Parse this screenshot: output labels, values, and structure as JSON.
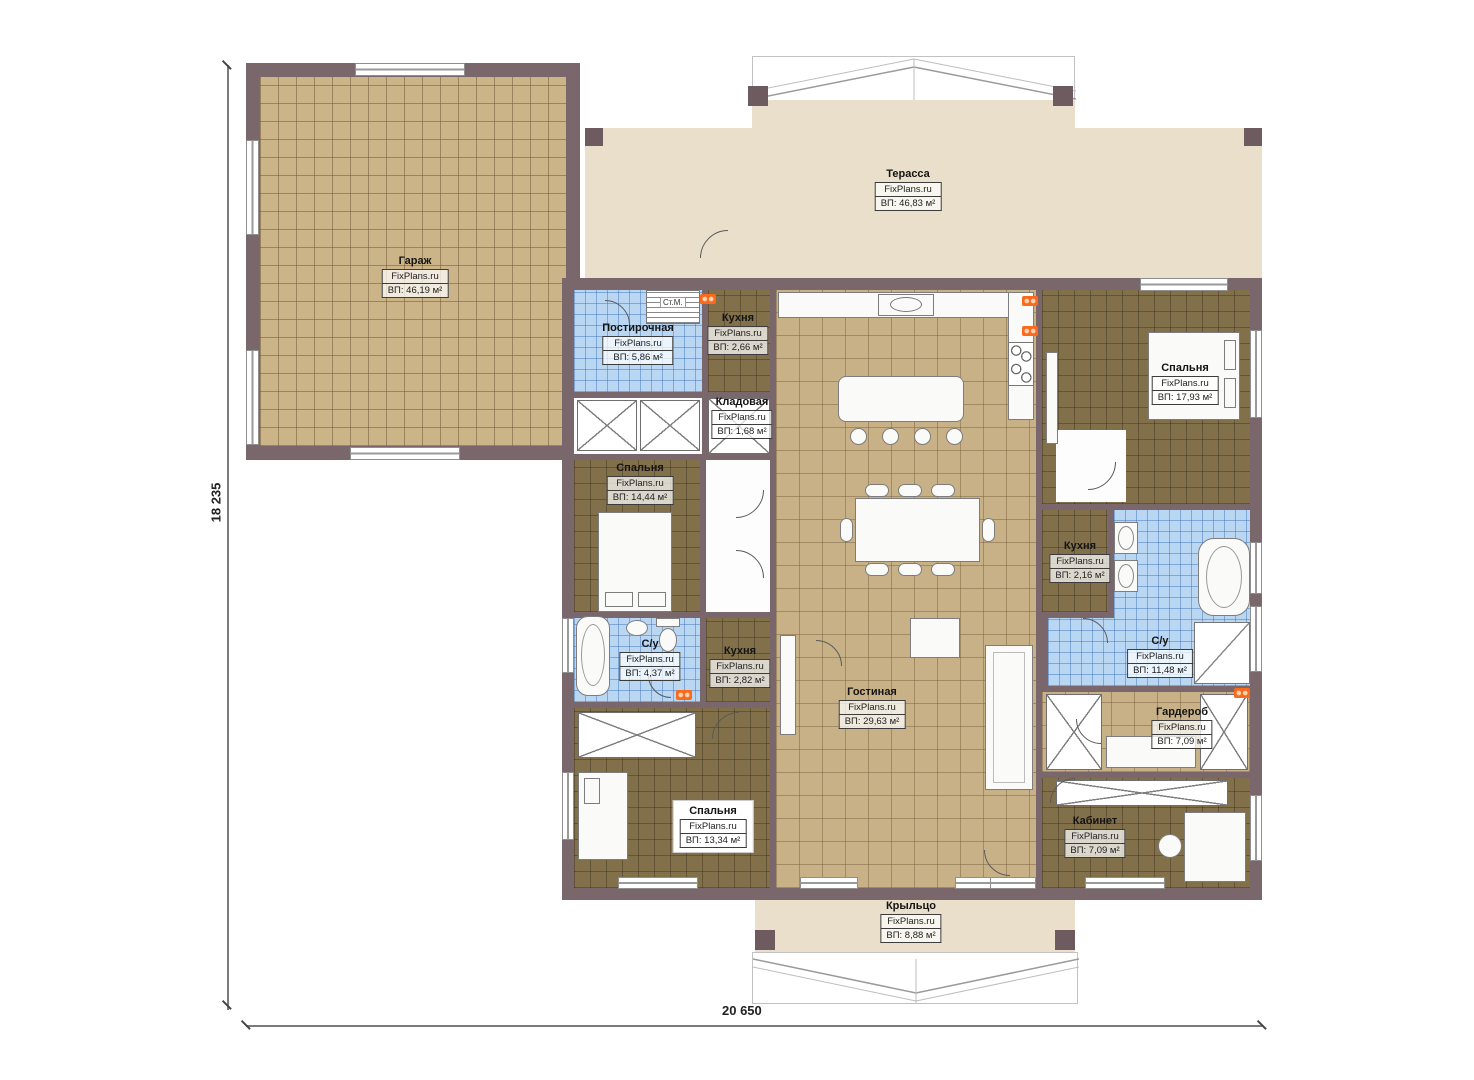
{
  "brand": "FixPlans.ru",
  "dimensions": {
    "height_label": "18 235",
    "width_label": "20 650"
  },
  "labels": {
    "washing_machine": "Ст.М."
  },
  "colors": {
    "wall": "#7a676b",
    "floor_tan": "#cbb488",
    "floor_brown": "#82704b",
    "floor_blue": "#b9d6f2",
    "terrace_beige": "#e9dfca",
    "radiator_orange": "#f96a1f"
  },
  "rooms": [
    {
      "name": "Гараж",
      "area": "ВП: 46,19 м²"
    },
    {
      "name": "Терасса",
      "area": "ВП: 46,83 м²"
    },
    {
      "name": "Постирочная",
      "area": "ВП: 5,86 м²"
    },
    {
      "name": "Кухня",
      "area": "ВП: 2,66 м²"
    },
    {
      "name": "Кладовая",
      "area": "ВП: 1,68 м²"
    },
    {
      "name": "Спальня",
      "area": "ВП: 14,44 м²"
    },
    {
      "name": "Спальня",
      "area": "ВП: 17,93 м²"
    },
    {
      "name": "Кухня",
      "area": "ВП: 2,16 м²"
    },
    {
      "name": "С/у",
      "area": "ВП: 4,37 м²"
    },
    {
      "name": "Кухня",
      "area": "ВП: 2,82 м²"
    },
    {
      "name": "Гостиная",
      "area": "ВП: 29,63 м²"
    },
    {
      "name": "С/у",
      "area": "ВП: 11,48 м²"
    },
    {
      "name": "Гардероб",
      "area": "ВП: 7,09 м²"
    },
    {
      "name": "Спальня",
      "area": "ВП: 13,34 м²"
    },
    {
      "name": "Кабинет",
      "area": "ВП: 7,09 м²"
    },
    {
      "name": "Крыльцо",
      "area": "ВП: 8,88 м²"
    }
  ]
}
